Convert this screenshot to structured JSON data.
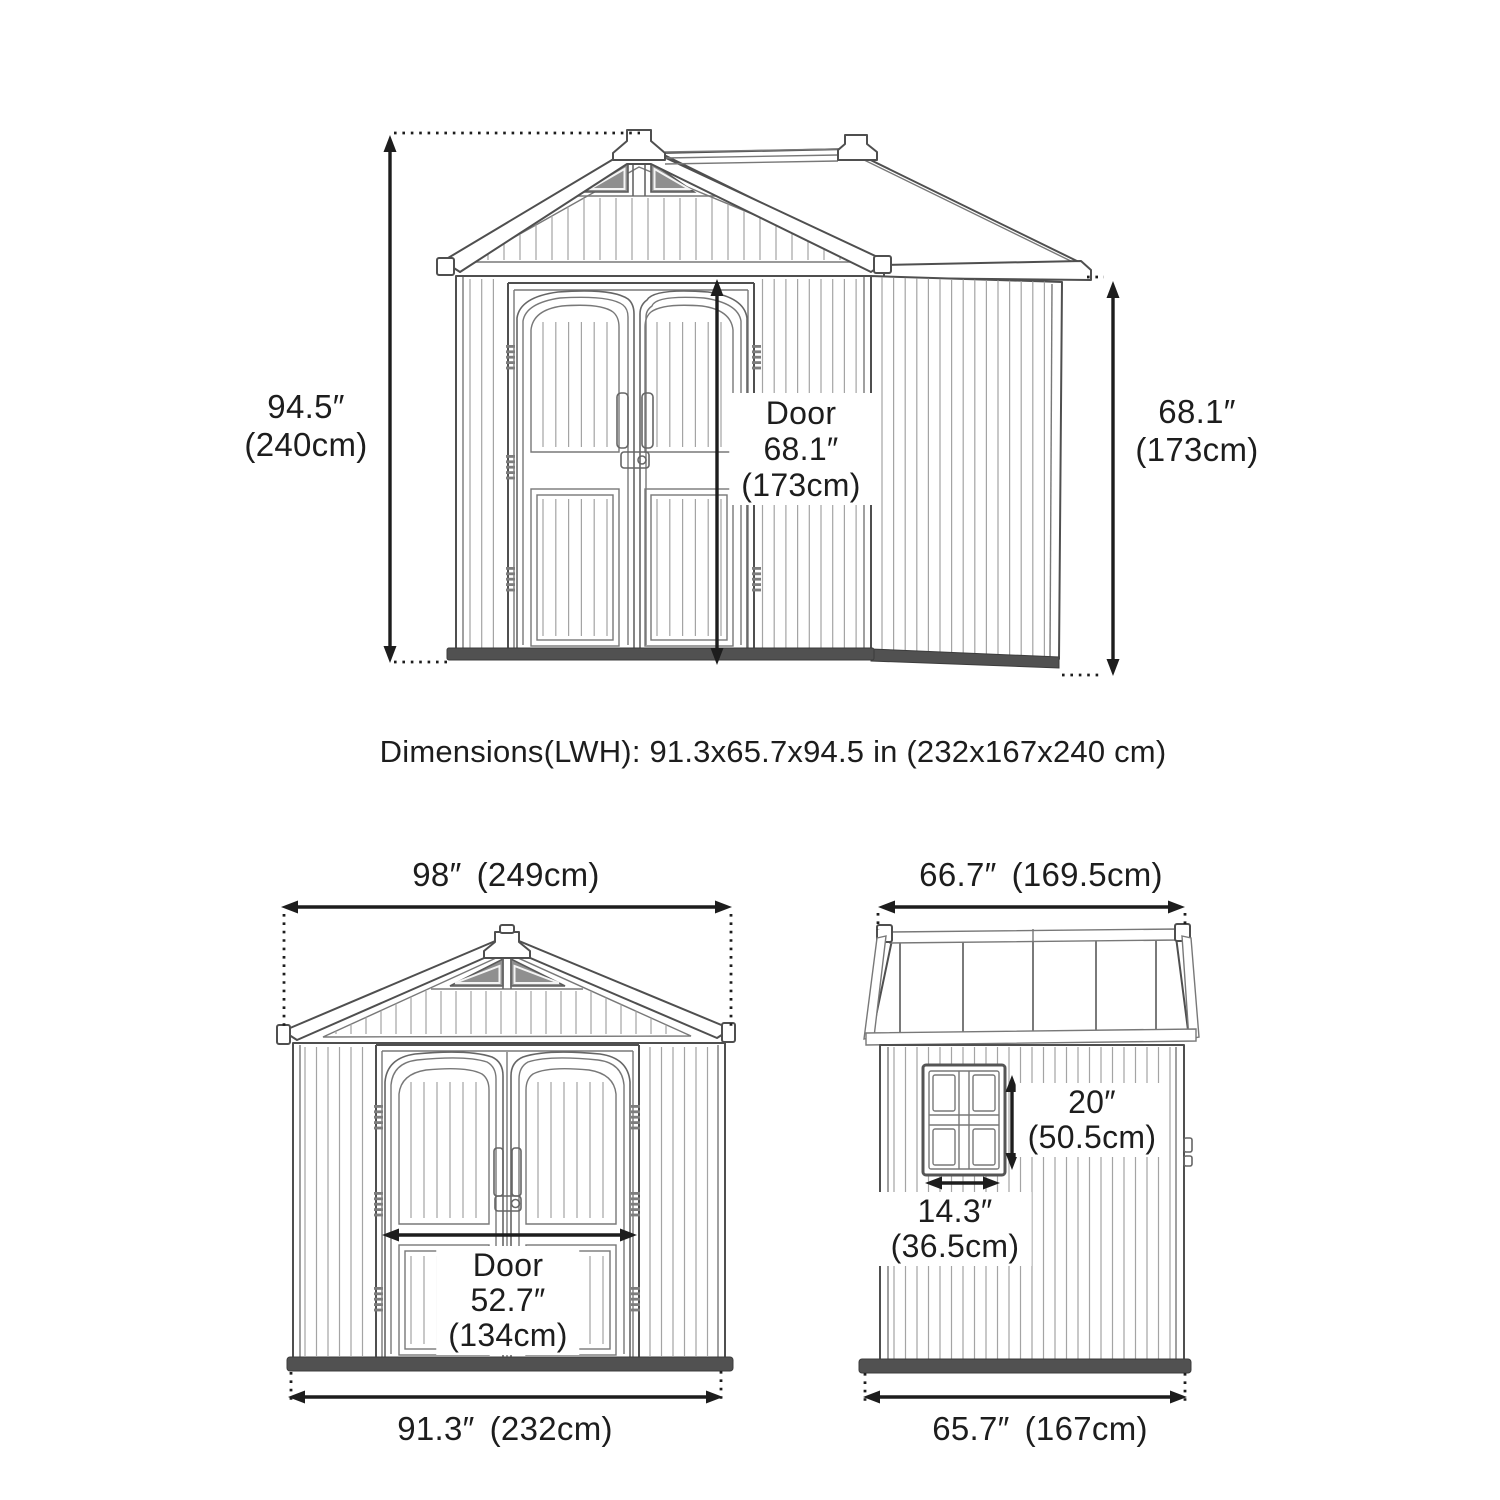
{
  "colors": {
    "background": "#ffffff",
    "line": "#4f4f4f",
    "text": "#1d1d1d",
    "arrow": "#1d1d1d"
  },
  "summary": {
    "text": "Dimensions(LWH): 91.3x65.7x94.5 in (232x167x240 cm)"
  },
  "perspective_view": {
    "overall_height": {
      "value": "94.5″",
      "metric": "(240cm)"
    },
    "door": {
      "label": "Door",
      "value": "68.1″",
      "metric": "(173cm)"
    },
    "wall_height": {
      "value": "68.1″",
      "metric": "(173cm)"
    }
  },
  "front_view": {
    "roof_width": {
      "value": "98″",
      "metric": "(249cm)"
    },
    "door": {
      "label": "Door",
      "value": "52.7″",
      "metric": "(134cm)"
    },
    "base_width": {
      "value": "91.3″",
      "metric": "(232cm)"
    }
  },
  "side_view": {
    "roof_depth": {
      "value": "66.7″",
      "metric": "(169.5cm)"
    },
    "window_height": {
      "value": "20″",
      "metric": "(50.5cm)"
    },
    "window_width": {
      "value": "14.3″",
      "metric": "(36.5cm)"
    },
    "base_depth": {
      "value": "65.7″",
      "metric": "(167cm)"
    }
  }
}
